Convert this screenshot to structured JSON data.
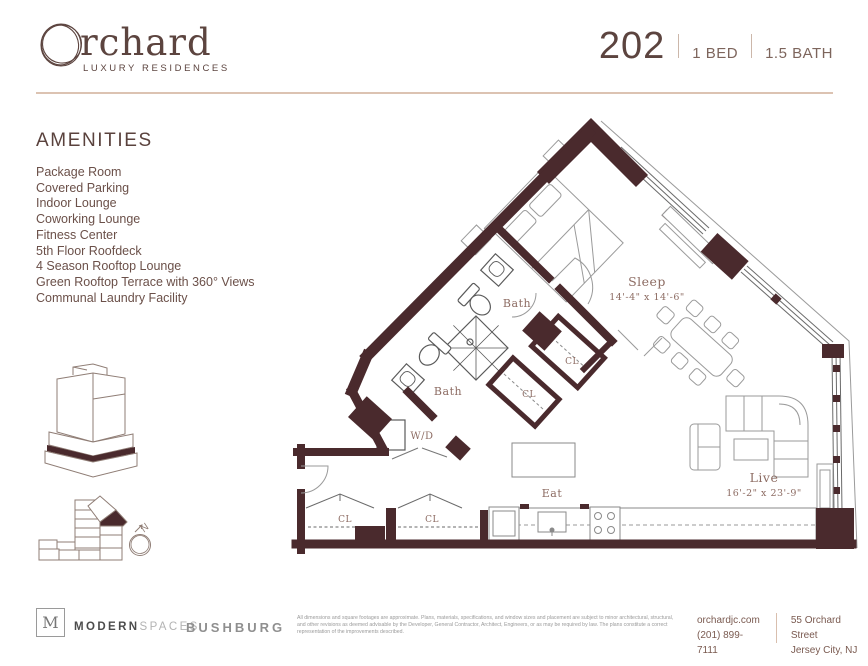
{
  "brand": {
    "name_rest": "rchard",
    "tagline": "LUXURY RESIDENCES"
  },
  "unit": {
    "number": "202",
    "bed": "1 BED",
    "bath": "1.5 BATH"
  },
  "amenities": {
    "title": "AMENITIES",
    "items": [
      "Package Room",
      "Covered Parking",
      "Indoor Lounge",
      "Coworking Lounge",
      "Fitness Center",
      "5th Floor Roofdeck",
      "4 Season Rooftop Lounge",
      "Green Rooftop Terrace with 360° Views",
      "Communal Laundry Facility"
    ]
  },
  "plan": {
    "compass": "N",
    "rooms": {
      "sleep": {
        "name": "Sleep",
        "dims": "14'-4\" x 14'-6\""
      },
      "bath_upper": {
        "name": "Bath"
      },
      "bath_lower": {
        "name": "Bath"
      },
      "closet_hall_upper": {
        "name": "CL"
      },
      "closet_hall_lower": {
        "name": "CL"
      },
      "washer_dryer": {
        "name": "W/D"
      },
      "closet_entry_left": {
        "name": "CL"
      },
      "closet_entry_right": {
        "name": "CL"
      },
      "eat": {
        "name": "Eat"
      },
      "live": {
        "name": "Live",
        "dims": "16'-2\" x 23'-9\""
      }
    }
  },
  "footer": {
    "modernspaces_initial": "M",
    "modernspaces_bold": "MODERN",
    "modernspaces_light": "SPACES",
    "bushburg": "BUSHBURG",
    "disclaimer": "All dimensions and square footages are approximate. Plans, materials, specifications, and window sizes and placement are subject to minor architectural, structural, and other revisions as deemed advisable by the Developer, General Contractor, Architect, Engineers, or as may be required by law. The plans constitute a correct representation of the improvements described.",
    "website": "orchardjc.com",
    "phone": "(201) 899-7111",
    "address_line1": "55 Orchard Street",
    "address_line2": "Jersey City, NJ"
  },
  "colors": {
    "wall": "#4a2a2d",
    "brand_text": "#5c443f",
    "plan_label": "#8d6c63",
    "divider": "#dcc3b2"
  }
}
